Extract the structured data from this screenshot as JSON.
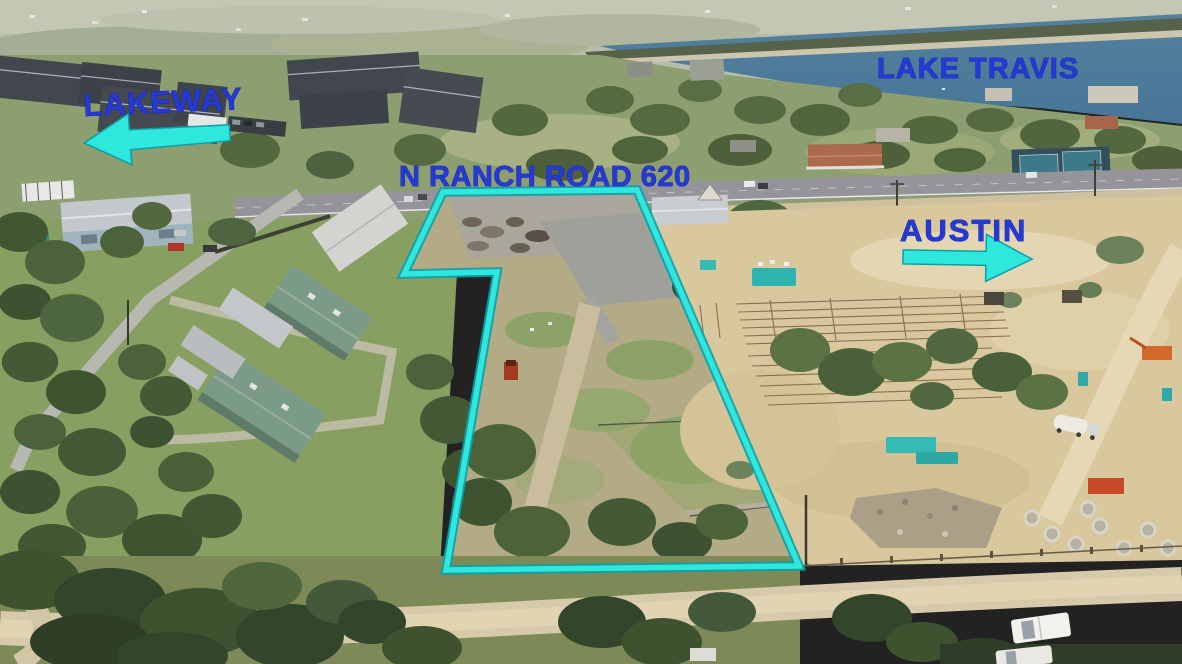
{
  "photo": {
    "description_labels": {
      "lakeway": "LAKEWAY",
      "lake_travis": "LAKE TRAVIS",
      "ranch_road": "N RANCH ROAD 620",
      "austin": "AUSTIN"
    },
    "arrows": {
      "lakeway_arrow": "left",
      "austin_arrow": "right"
    },
    "colors": {
      "label_blue": "#2439d6",
      "annotation_cyan": "#2fe8dd",
      "annotation_cyan_edge": "#0d9fa8"
    },
    "parcel_outline": {
      "shape": "flag-shaped boundary polygon",
      "stroke": "#2fe8dd"
    }
  }
}
